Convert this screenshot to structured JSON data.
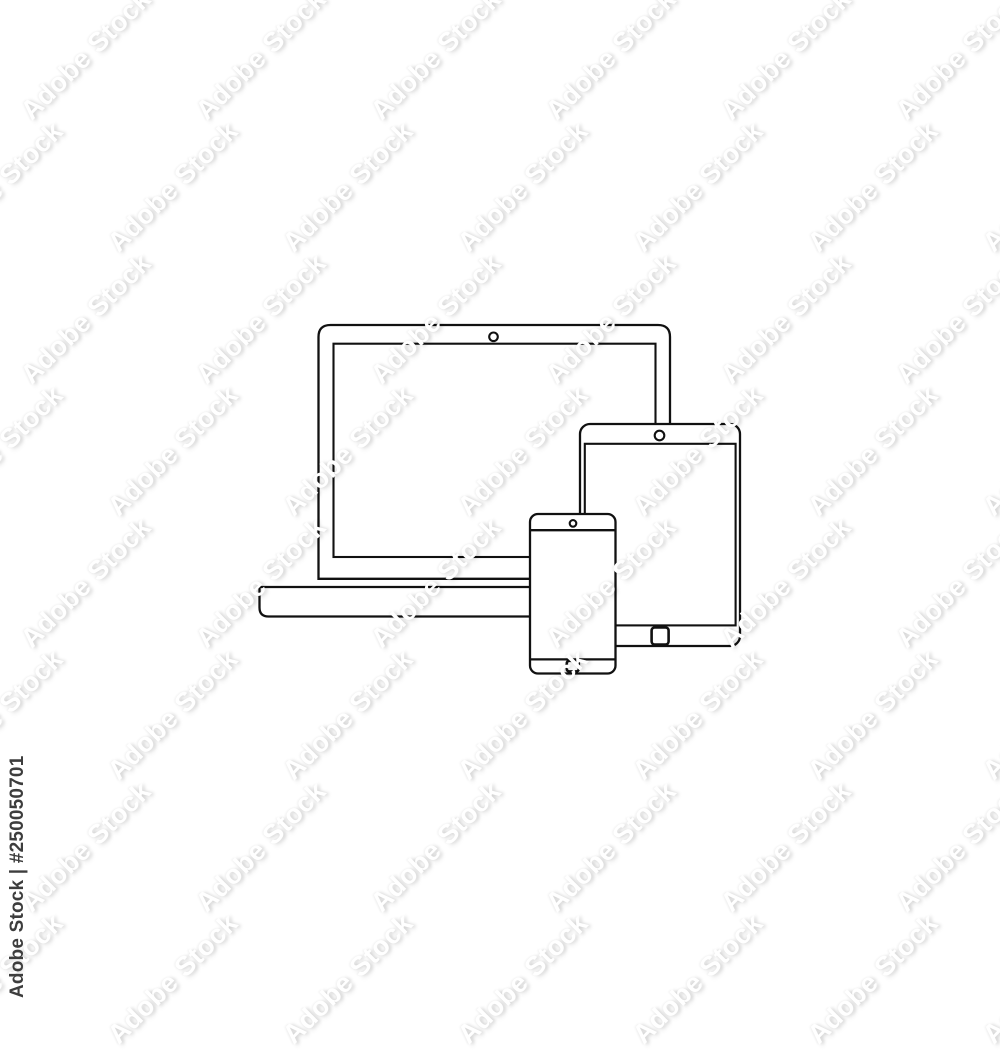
{
  "image": {
    "background_color": "#ffffff",
    "stroke_color": "#111111",
    "description": "Outline line icon of responsive devices: open laptop, tablet and smartphone overlapping"
  },
  "icon": {
    "name": "responsive-devices-outline-icon",
    "devices": [
      "laptop",
      "tablet",
      "smartphone"
    ]
  },
  "watermark": {
    "brand": "Adobe Stock",
    "tile_text": "Adobe Stock",
    "asset_id": "#250050701",
    "corner_text": "Adobe Stock | #250050701",
    "corner_text_color": "#3d3d3d"
  }
}
